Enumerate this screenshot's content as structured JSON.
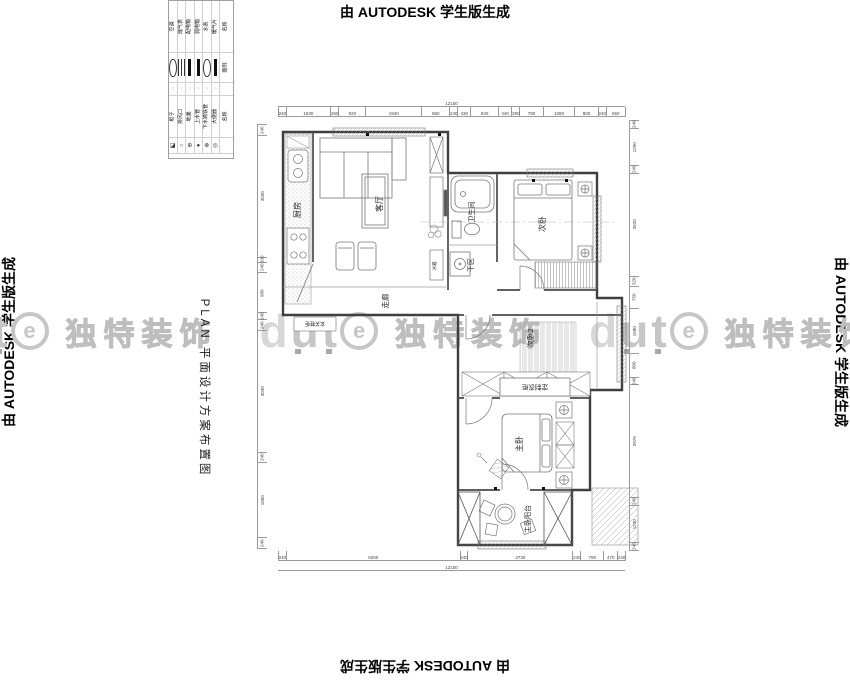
{
  "edge_watermark": "由 AUTODESK 学生版生成",
  "brand": {
    "logo_d": "d",
    "logo_u": "u",
    "logo_t": "t",
    "logo_e": "e",
    "name": "独特装饰",
    "color": "#c6c6c6"
  },
  "title_block": {
    "plan_title": "PLAN 平面设计方案布置图"
  },
  "legend": {
    "name_header": "名称",
    "symbol_header": "图例",
    "items_top": [
      "空调",
      "煤气表",
      "配电箱",
      "弱电箱",
      "水表",
      "暖气片"
    ],
    "dots": [
      "○",
      "○",
      "○",
      "○",
      "○",
      "○"
    ],
    "name_header2": "名称",
    "items_bottom": [
      "柜子",
      "排风口",
      "地漏",
      "上水管",
      "下水铸铁管",
      "大便器"
    ],
    "symbols_bottom": [
      "◪",
      "○",
      "⊕",
      "●",
      "⊗",
      "◎"
    ]
  },
  "rooms": {
    "kitchen": "厨房",
    "living": "客厅",
    "bathroom": "卫生间",
    "bedroom2": "次卧",
    "dry_area": "干区",
    "corridor": "走廊",
    "bedroom3": "次卧2",
    "wardrobe": "定制衣柜",
    "master": "主卧",
    "balcony": "主卧阳台",
    "shoe_cabinet": "玄关鞋柜",
    "fridge": "冰箱"
  },
  "dimensions": {
    "top": {
      "total": "12150",
      "segments": [
        "240",
        "1530",
        "260",
        "920",
        "1940",
        "960",
        "240",
        "430",
        "940",
        "440",
        "250",
        "790",
        "1080",
        "800",
        "240",
        "650"
      ]
    },
    "bottom": {
      "total": "12150",
      "segments": [
        "240",
        "6200",
        "240",
        "3730",
        "240",
        "790",
        "470",
        "240"
      ]
    },
    "left": {
      "segments": [
        "240",
        "3030",
        "100",
        "240",
        "980",
        "140",
        "240",
        "3030",
        "240",
        "1860",
        "240"
      ]
    },
    "right": {
      "segments": [
        "240",
        "1290",
        "240",
        "3620",
        "320",
        "750",
        "1580",
        "800",
        "240",
        "3970",
        "240",
        "1290",
        "240"
      ]
    }
  }
}
